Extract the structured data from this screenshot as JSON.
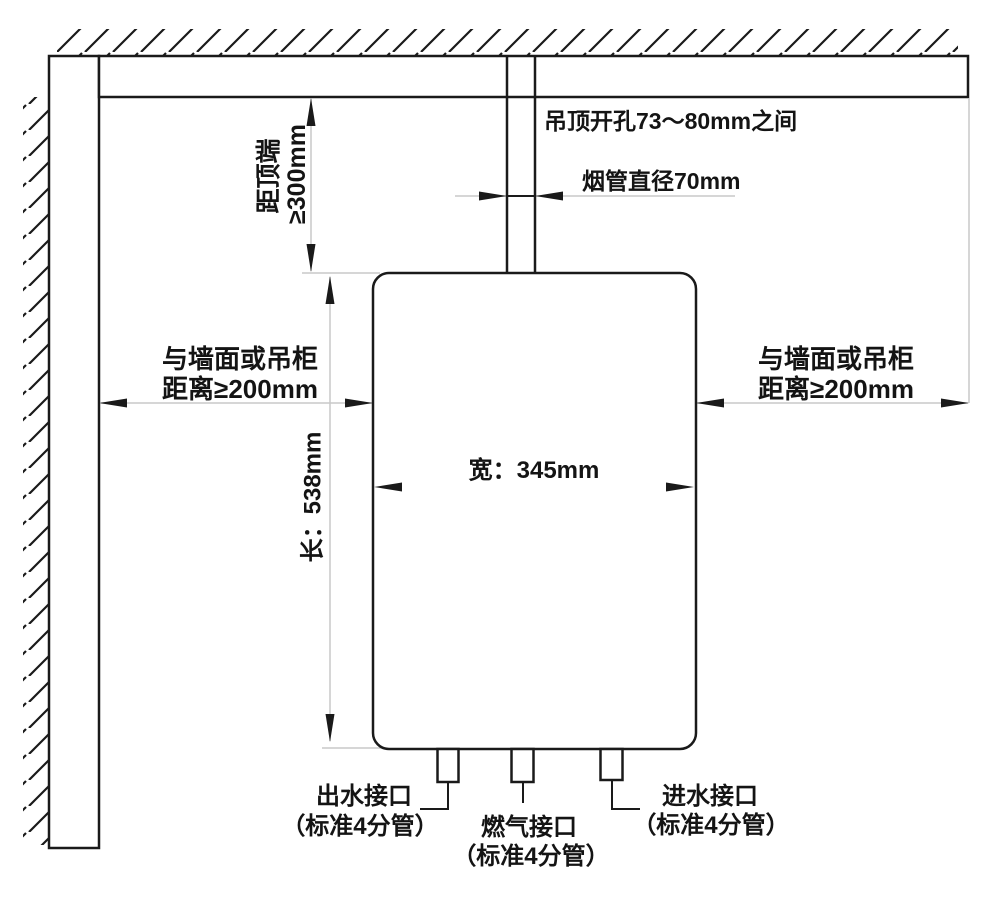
{
  "diagram": {
    "kind": "water-heater-installation-clearance-diagram",
    "background": "#ffffff",
    "line_color": "#1a1a1a",
    "dim_line_color": "#c9c9c9",
    "annotations": {
      "ceiling_hole": "吊顶开孔73～80mm之间",
      "flue_diameter": "烟管直径70mm",
      "top_clearance": {
        "line1": "距顶端",
        "line2": "≥300mm"
      },
      "left_clearance": {
        "line1": "与墙面或吊柜",
        "line2": "距离≥200mm"
      },
      "right_clearance": {
        "line1": "与墙面或吊柜",
        "line2": "距离≥200mm"
      },
      "height_label": "长：538mm",
      "width_label": "宽：345mm",
      "connections": {
        "outlet": {
          "label": "出水接口",
          "sub": "（标准4分管）"
        },
        "gas": {
          "label": "燃气接口",
          "sub": "（标准4分管）"
        },
        "inlet": {
          "label": "进水接口",
          "sub": "（标准4分管）"
        }
      }
    },
    "values": {
      "top_clearance": "≥300mm",
      "side_clearance": "≥200mm",
      "body_height_mm": 538,
      "body_width_mm": 345,
      "flue_diameter_mm": 70,
      "ceiling_hole_range": "73～80mm"
    }
  }
}
